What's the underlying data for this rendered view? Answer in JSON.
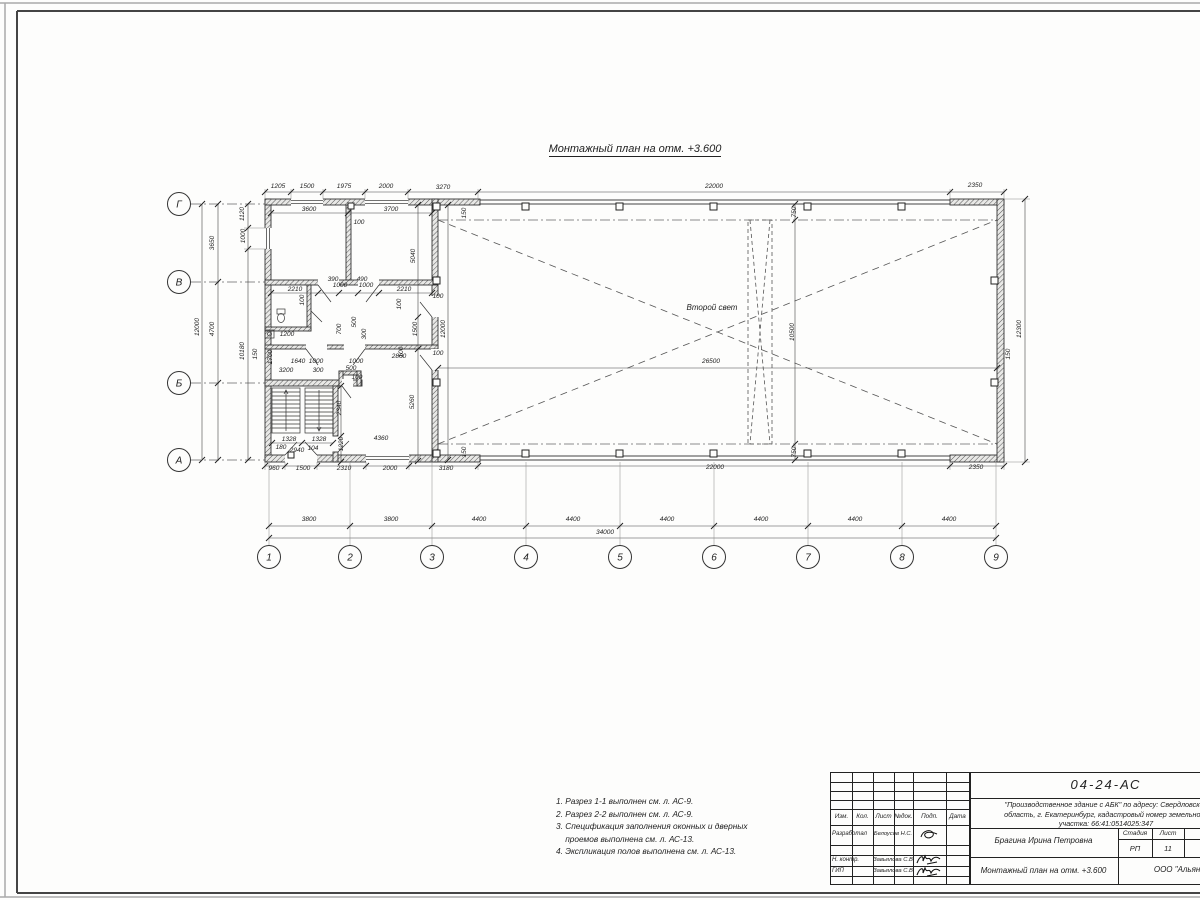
{
  "drawing_title": "Монтажный план на отм. +3.600",
  "plan": {
    "second_light_label": "Второй свет",
    "axes_left": [
      {
        "label": "Г",
        "cx": 179,
        "cy": 204
      },
      {
        "label": "В",
        "cx": 179,
        "cy": 282
      },
      {
        "label": "Б",
        "cx": 179,
        "cy": 383
      },
      {
        "label": "А",
        "cx": 179,
        "cy": 460
      }
    ],
    "axes_bottom": [
      {
        "label": "1",
        "cx": 269,
        "cy": 557
      },
      {
        "label": "2",
        "cx": 350,
        "cy": 557
      },
      {
        "label": "3",
        "cx": 432,
        "cy": 557
      },
      {
        "label": "4",
        "cx": 526,
        "cy": 557
      },
      {
        "label": "5",
        "cx": 620,
        "cy": 557
      },
      {
        "label": "6",
        "cx": 714,
        "cy": 557
      },
      {
        "label": "7",
        "cx": 808,
        "cy": 557
      },
      {
        "label": "8",
        "cx": 902,
        "cy": 557
      },
      {
        "label": "9",
        "cx": 996,
        "cy": 557
      }
    ],
    "dim_labels": [
      {
        "t": "1205",
        "x": 278,
        "y": 188
      },
      {
        "t": "1500",
        "x": 307,
        "y": 188
      },
      {
        "t": "1975",
        "x": 344,
        "y": 188
      },
      {
        "t": "2000",
        "x": 386,
        "y": 188
      },
      {
        "t": "3270",
        "x": 443,
        "y": 189
      },
      {
        "t": "22000",
        "x": 714,
        "y": 188
      },
      {
        "t": "2350",
        "x": 975,
        "y": 187
      },
      {
        "t": "3600",
        "x": 309,
        "y": 211
      },
      {
        "t": "3700",
        "x": 391,
        "y": 211
      },
      {
        "t": "100",
        "x": 359,
        "y": 224
      },
      {
        "t": "150",
        "x": 466,
        "y": 213,
        "r": 1
      },
      {
        "t": "5040",
        "x": 415,
        "y": 256,
        "r": 1
      },
      {
        "t": "2210",
        "x": 295,
        "y": 291
      },
      {
        "t": "390",
        "x": 333,
        "y": 281
      },
      {
        "t": "490",
        "x": 362,
        "y": 281
      },
      {
        "t": "1000",
        "x": 340,
        "y": 287
      },
      {
        "t": "1000",
        "x": 366,
        "y": 287
      },
      {
        "t": "2210",
        "x": 404,
        "y": 291
      },
      {
        "t": "100",
        "x": 304,
        "y": 300,
        "r": 1
      },
      {
        "t": "100",
        "x": 401,
        "y": 304,
        "r": 1
      },
      {
        "t": "100",
        "x": 438,
        "y": 298
      },
      {
        "t": "500",
        "x": 356,
        "y": 322,
        "r": 1
      },
      {
        "t": "300",
        "x": 366,
        "y": 334,
        "r": 1
      },
      {
        "t": "700",
        "x": 341,
        "y": 329,
        "r": 1
      },
      {
        "t": "1200",
        "x": 287,
        "y": 336
      },
      {
        "t": "1500",
        "x": 417,
        "y": 329,
        "r": 1
      },
      {
        "t": "12000",
        "x": 445,
        "y": 329,
        "r": 1
      },
      {
        "t": "1700",
        "x": 272,
        "y": 357,
        "r": 1
      },
      {
        "t": "1640",
        "x": 298,
        "y": 363
      },
      {
        "t": "1000",
        "x": 316,
        "y": 363
      },
      {
        "t": "1000",
        "x": 356,
        "y": 363
      },
      {
        "t": "2860",
        "x": 399,
        "y": 358
      },
      {
        "t": "100",
        "x": 403,
        "y": 352,
        "r": 1
      },
      {
        "t": "100",
        "x": 438,
        "y": 355
      },
      {
        "t": "3200",
        "x": 286,
        "y": 372
      },
      {
        "t": "300",
        "x": 318,
        "y": 372
      },
      {
        "t": "500",
        "x": 351,
        "y": 370
      },
      {
        "t": "100",
        "x": 357,
        "y": 379
      },
      {
        "t": "1328",
        "x": 289,
        "y": 441
      },
      {
        "t": "1328",
        "x": 319,
        "y": 441
      },
      {
        "t": "180",
        "x": 281,
        "y": 449
      },
      {
        "t": "2940",
        "x": 297,
        "y": 452
      },
      {
        "t": "104",
        "x": 313,
        "y": 450
      },
      {
        "t": "1220",
        "x": 343,
        "y": 444,
        "r": 1
      },
      {
        "t": "2340",
        "x": 341,
        "y": 408,
        "r": 1
      },
      {
        "t": "5260",
        "x": 414,
        "y": 402,
        "r": 1
      },
      {
        "t": "4360",
        "x": 381,
        "y": 440
      },
      {
        "t": "150",
        "x": 466,
        "y": 452,
        "r": 1
      },
      {
        "t": "960",
        "x": 274,
        "y": 470
      },
      {
        "t": "1500",
        "x": 303,
        "y": 470
      },
      {
        "t": "2310",
        "x": 344,
        "y": 470
      },
      {
        "t": "2000",
        "x": 390,
        "y": 470
      },
      {
        "t": "3180",
        "x": 446,
        "y": 470
      },
      {
        "t": "22000",
        "x": 715,
        "y": 469
      },
      {
        "t": "2350",
        "x": 976,
        "y": 469
      },
      {
        "t": "1120",
        "x": 244,
        "y": 214,
        "r": 1
      },
      {
        "t": "1000",
        "x": 245,
        "y": 236,
        "r": 1
      },
      {
        "t": "3650",
        "x": 214,
        "y": 243,
        "r": 1
      },
      {
        "t": "12000",
        "x": 199,
        "y": 327,
        "r": 1
      },
      {
        "t": "4700",
        "x": 214,
        "y": 329,
        "r": 1
      },
      {
        "t": "10180",
        "x": 244,
        "y": 351,
        "r": 1
      },
      {
        "t": "150",
        "x": 257,
        "y": 354,
        "r": 1
      },
      {
        "t": "12300",
        "x": 1021,
        "y": 329,
        "r": 1
      },
      {
        "t": "150",
        "x": 1010,
        "y": 354,
        "r": 1
      },
      {
        "t": "750",
        "x": 796,
        "y": 212,
        "r": 1
      },
      {
        "t": "750",
        "x": 796,
        "y": 452,
        "r": 1
      },
      {
        "t": "10500",
        "x": 794,
        "y": 332,
        "r": 1
      },
      {
        "t": "26500",
        "x": 711,
        "y": 363
      },
      {
        "t": "3800",
        "x": 309,
        "y": 521
      },
      {
        "t": "3800",
        "x": 391,
        "y": 521
      },
      {
        "t": "4400",
        "x": 479,
        "y": 521
      },
      {
        "t": "4400",
        "x": 573,
        "y": 521
      },
      {
        "t": "4400",
        "x": 667,
        "y": 521
      },
      {
        "t": "4400",
        "x": 761,
        "y": 521
      },
      {
        "t": "4400",
        "x": 855,
        "y": 521
      },
      {
        "t": "4400",
        "x": 949,
        "y": 521
      },
      {
        "t": "34000",
        "x": 605,
        "y": 534
      }
    ]
  },
  "notes_text": "1. Разрез 1-1 выполнен см. л. АС-9.\n2. Разрез 2-2 выполнен см. л. АС-9.\n3. Спецификация заполнения оконных и дверных\n    проемов выполнена см. л. АС-13.\n4. Экспликация полов выполнена см. л. АС-13.",
  "title_block": {
    "doc_number": "04-24-АС",
    "project_line1": "\"Производственное здание с АБК\" по адресу: Свердловская",
    "project_line2": "область, г. Екатеринбург, кадастровый номер земельного",
    "project_line3": "участка: 66:41:0514025:347",
    "columns_header": [
      "Изм.",
      "Кол.",
      "Лист",
      "№док.",
      "Подп.",
      "Дата"
    ],
    "rows": [
      {
        "role": "Разработал",
        "name": "Белоусов Н.С."
      },
      {
        "role": "Н. контр.",
        "name": "Завьялова С.В"
      },
      {
        "role": "ГИП",
        "name": "Завьялова С.В"
      }
    ],
    "author": "Брагина Ирина Петровна",
    "stage_header": [
      "Стадия",
      "Лист",
      "Листов"
    ],
    "stage": "РП",
    "sheet": "11",
    "sheets": "13",
    "sheet_title": "Монтажный план на отм. +3.600",
    "company": "ООО \"Альянс\""
  }
}
